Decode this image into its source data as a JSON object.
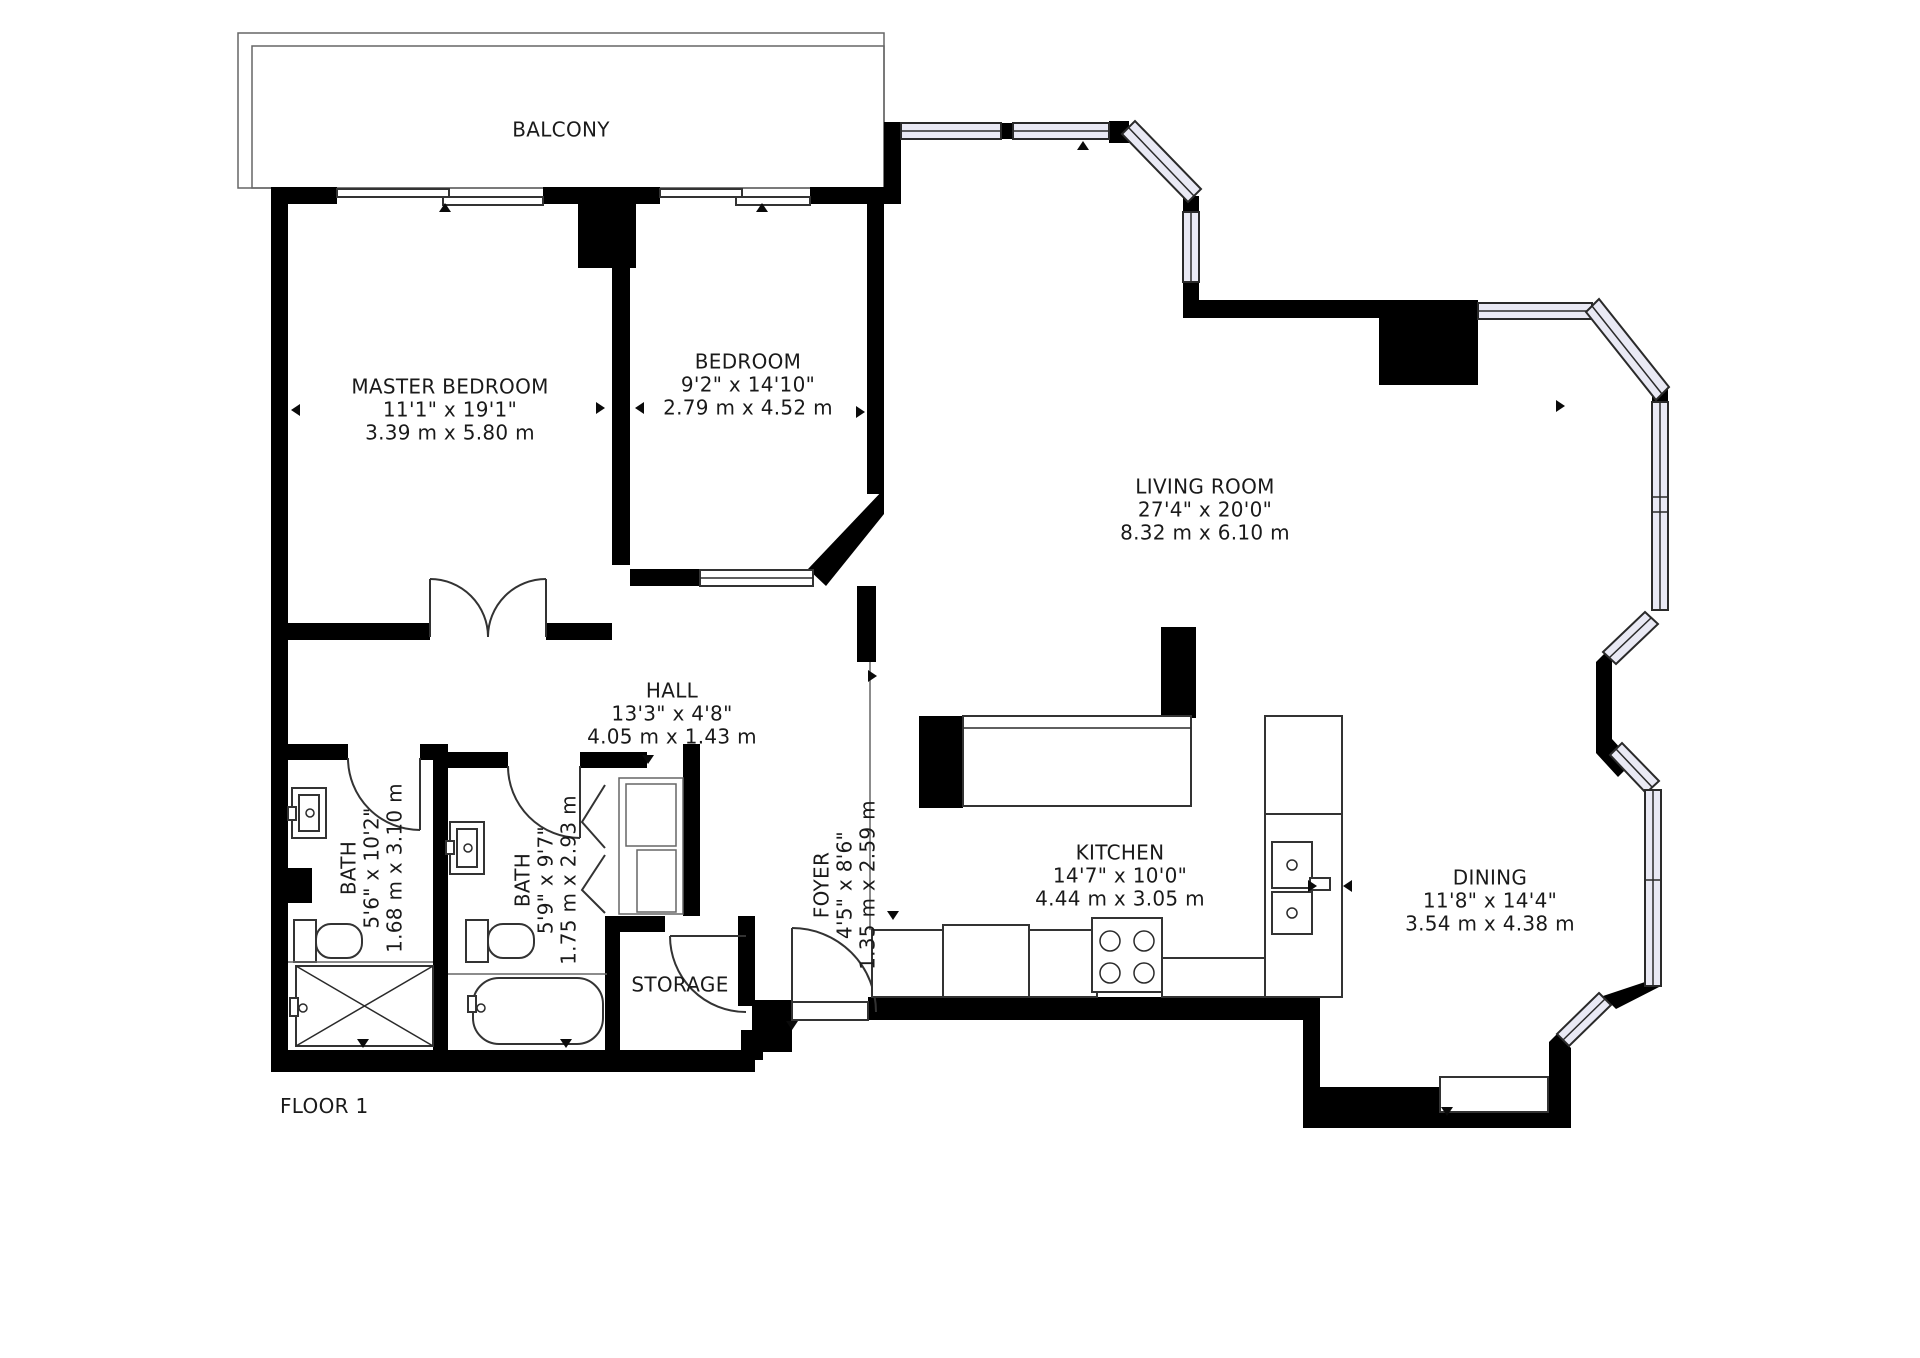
{
  "floor": {
    "label": "FLOOR 1"
  },
  "balcony": {
    "label": "BALCONY"
  },
  "rooms": {
    "master_bedroom": {
      "name": "MASTER BEDROOM",
      "imperial": "11'1\" x 19'1\"",
      "metric": "3.39 m x 5.80 m"
    },
    "bedroom": {
      "name": "BEDROOM",
      "imperial": "9'2\" x 14'10\"",
      "metric": "2.79 m x 4.52 m"
    },
    "living_room": {
      "name": "LIVING ROOM",
      "imperial": "27'4\" x 20'0\"",
      "metric": "8.32 m x 6.10 m"
    },
    "hall": {
      "name": "HALL",
      "imperial": "13'3\" x 4'8\"",
      "metric": "4.05 m x 1.43 m"
    },
    "kitchen": {
      "name": "KITCHEN",
      "imperial": "14'7\" x 10'0\"",
      "metric": "4.44 m x 3.05 m"
    },
    "dining": {
      "name": "DINING",
      "imperial": "11'8\" x 14'4\"",
      "metric": "3.54 m x 4.38 m"
    },
    "bath_1": {
      "name": "BATH",
      "imperial": "5'6\" x 10'2\"",
      "metric": "1.68 m x 3.10 m"
    },
    "bath_2": {
      "name": "BATH",
      "imperial": "5'9\" x 9'7\"",
      "metric": "1.75 m x 2.93 m"
    },
    "foyer": {
      "name": "FOYER",
      "imperial": "4'5\" x 8'6\"",
      "metric": "1.35 m x 2.59 m"
    },
    "storage": {
      "name": "STORAGE"
    }
  },
  "colors": {
    "wall": "#000000",
    "window_fill": "#e9e9f4",
    "line": "#333333",
    "text": "#1a1a1a",
    "background": "#ffffff"
  }
}
